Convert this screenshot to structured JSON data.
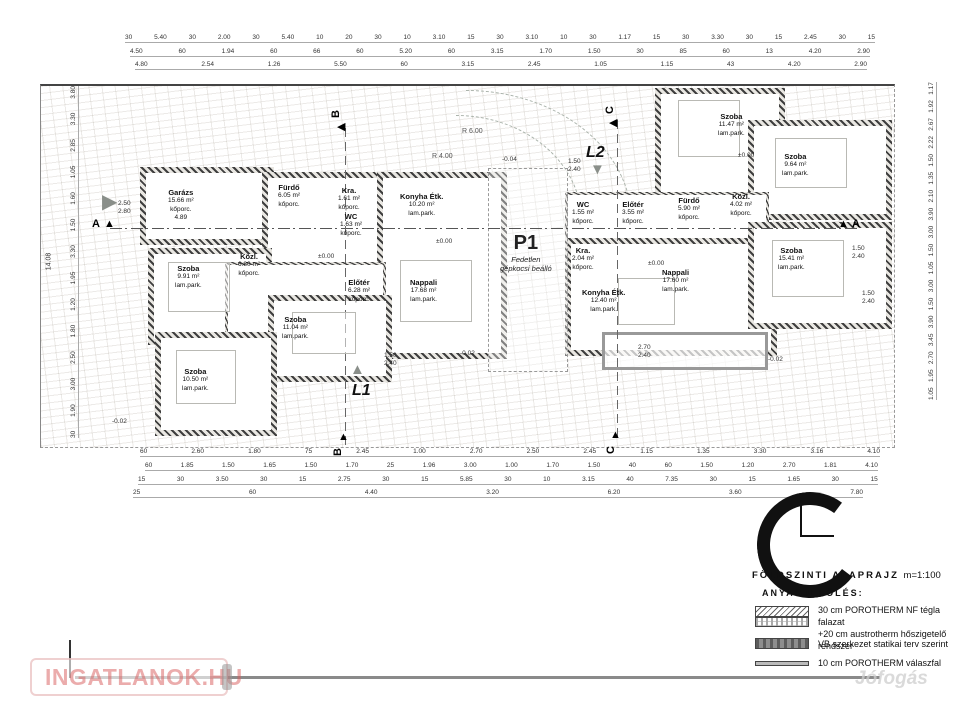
{
  "title": {
    "name": "FÖLDSZINTI ALAPRAJZ",
    "scale": "m=1:100"
  },
  "legend": {
    "heading": "ANYAGJELÖLÉS:",
    "items": [
      {
        "line1": "30 cm POROTHERM NF tégla falazat",
        "line2": "+20 cm austrotherm hőszigetelő rendszer"
      },
      {
        "line1": "VB szerkezet statikai terv szerint"
      },
      {
        "line1": "10 cm POROTHERM válaszfal"
      }
    ]
  },
  "carport": {
    "code": "P1",
    "line1": "Fedetlen",
    "line2": "gépkocsi beálló"
  },
  "markers": {
    "a": "A",
    "b": "B",
    "c": "C",
    "l1": "L1",
    "l2": "L2"
  },
  "levels": {
    "zero": "±0.00",
    "m002": "-0.02",
    "m004": "-0.04"
  },
  "radii": {
    "r6": "R 6.00",
    "r4": "R 4.00"
  },
  "rooms": {
    "left": [
      {
        "name": "Garázs",
        "area": "15.66 m²",
        "finish": "kőporc.",
        "note": "4.89"
      },
      {
        "name": "Fürdő",
        "area": "6.05 m²",
        "finish": "kőporc."
      },
      {
        "name": "Kra.",
        "area": "1.61 m²",
        "finish": "kőporc."
      },
      {
        "name": "WC",
        "area": "1.63 m²",
        "finish": "kőporc."
      },
      {
        "name": "Konyha Étk.",
        "area": "10.20 m²",
        "finish": "lam.park."
      },
      {
        "name": "Szoba",
        "area": "9.91 m²",
        "finish": "lam.park."
      },
      {
        "name": "Közl.",
        "area": "6.80 m²",
        "finish": "kőporc."
      },
      {
        "name": "Előtér",
        "area": "6.28 m²",
        "finish": "kőporc."
      },
      {
        "name": "Nappali",
        "area": "17.68 m²",
        "finish": "lam.park."
      },
      {
        "name": "Szoba",
        "area": "11.04 m²",
        "finish": "lam.park."
      },
      {
        "name": "Szoba",
        "area": "10.50 m²",
        "finish": "lam.park."
      }
    ],
    "right": [
      {
        "name": "Szoba",
        "area": "11.47 m²",
        "finish": "lam.park."
      },
      {
        "name": "Szoba",
        "area": "9.64 m²",
        "finish": "lam.park."
      },
      {
        "name": "WC",
        "area": "1.55 m²",
        "finish": "kőporc."
      },
      {
        "name": "Előtér",
        "area": "3.55 m²",
        "finish": "kőporc."
      },
      {
        "name": "Fürdő",
        "area": "5.90 m²",
        "finish": "kőporc."
      },
      {
        "name": "Közl.",
        "area": "4.02 m²",
        "finish": "kőporc."
      },
      {
        "name": "Kra.",
        "area": "2.04 m²",
        "finish": "kőporc."
      },
      {
        "name": "Szoba",
        "area": "15.41 m²",
        "finish": "lam.park."
      },
      {
        "name": "Nappali",
        "area": "17.60 m²",
        "finish": "lam.park."
      },
      {
        "name": "Konyha Étk.",
        "area": "12.40 m²",
        "finish": "lam.park."
      }
    ]
  },
  "dims": {
    "top1": "30 5.40 30 2.00 30 5.40 10 20 30 10 3.10 15 30 3.10 10 30 1.17 15 30 3.30 30 15 2.45 30 15",
    "top2": "4.50 60 1.94 60 66 60 5.20 60 3.15 1.70 1.50 30 85 60 13 4.20 2.90",
    "top3": "4.80 2.54 1.26 5.50 60 3.15 2.45 1.05 1.15 43 4.20 2.90",
    "bot1": "60 2.60 1.80 75 2.45 1.00 2.70 2.50 2.45 1.15 1.35 3.30 3.16 4.10",
    "bot2": "60 1.85 1.50 1.65 1.50 1.70 25 1.96 3.00 1.00 1.70 1.50 40 60 1.50 1.20 2.70 1.81 4.10",
    "bot3": "15 30 3.50 30 15 2.75 30 15 5.85 30 10 3.15 40 7.35 30 15 1.65 30 15",
    "bot4": "25 60 4.40 3.20 6.20 3.60 7.80",
    "left_total": "14.08",
    "left_col": "30 1.90 3.00 2.50 1.80 1.20 1.95 3.30 1.50 1.60 1.05 2.85 3.30 3.80",
    "right_col": "1.05 1.95 2.70 3.45 3.90 1.50 3.00 1.05 1.50 3.00 3.90 2.10 1.35 1.50 2.22 2.67 1.92 1.17",
    "pairs": [
      {
        "a": "2.50",
        "b": "2.80"
      },
      {
        "a": "1.50",
        "b": "2.40"
      },
      {
        "a": "1.50",
        "b": "2.40"
      },
      {
        "a": "1.50",
        "b": "2.40"
      },
      {
        "a": "2.70",
        "b": "2.40"
      },
      {
        "a": "1.50",
        "b": "2.40"
      }
    ]
  },
  "watermark": {
    "brand": "INGATLANOK.HU",
    "jofogas": "Jófogás"
  }
}
